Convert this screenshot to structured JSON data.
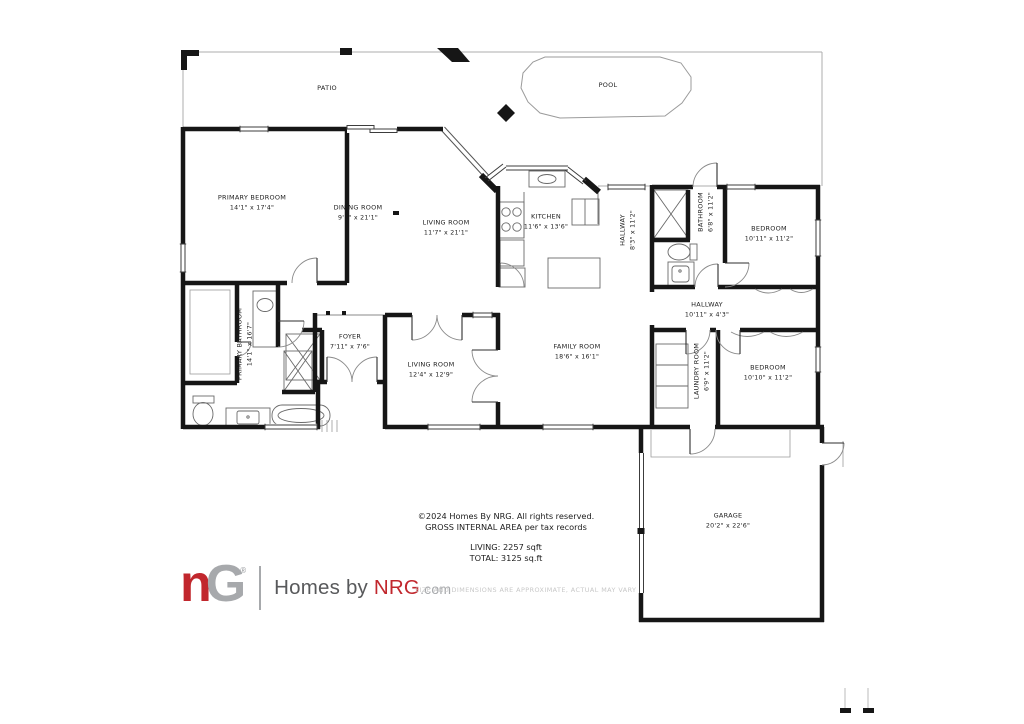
{
  "colors": {
    "wall": "#161616",
    "thin_line": "#aeaeae",
    "fixture_line": "#6a6a6a",
    "logo_red": "#c1272d",
    "logo_gray": "#a7a9ac",
    "brand_gray": "#58595b"
  },
  "plan": {
    "rooms": [
      {
        "name": "PATIO",
        "dims": "",
        "x": 327,
        "y": 89,
        "rot": false
      },
      {
        "name": "POOL",
        "dims": "",
        "x": 608,
        "y": 86,
        "rot": false
      },
      {
        "name": "PRIMARY BEDROOM",
        "dims": "14'1\" x 17'4\"",
        "x": 252,
        "y": 203,
        "rot": false
      },
      {
        "name": "DINING ROOM",
        "dims": "9'1\" x 21'1\"",
        "x": 358,
        "y": 213,
        "rot": false
      },
      {
        "name": "LIVING ROOM",
        "dims": "11'7\" x 21'1\"",
        "x": 446,
        "y": 228,
        "rot": false
      },
      {
        "name": "KITCHEN",
        "dims": "11'6\" x 13'6\"",
        "x": 546,
        "y": 222,
        "rot": false
      },
      {
        "name": "HALLWAY",
        "dims": "8'3\" x 11'2\"",
        "x": 628,
        "y": 230,
        "rot": true
      },
      {
        "name": "BATHROOM",
        "dims": "6'8\" x 11'2\"",
        "x": 706,
        "y": 212,
        "rot": true
      },
      {
        "name": "BEDROOM",
        "dims": "10'11\" x 11'2\"",
        "x": 769,
        "y": 234,
        "rot": false
      },
      {
        "name": "HALLWAY",
        "dims": "10'11\" x 4'3\"",
        "x": 707,
        "y": 310,
        "rot": false
      },
      {
        "name": "PRIMARY BATHROOM",
        "dims": "14'1\" x 16'7\"",
        "x": 245,
        "y": 344,
        "rot": true
      },
      {
        "name": "FOYER",
        "dims": "7'11\" x 7'6\"",
        "x": 350,
        "y": 342,
        "rot": false
      },
      {
        "name": "LIVING ROOM",
        "dims": "12'4\" x 12'9\"",
        "x": 431,
        "y": 370,
        "rot": false
      },
      {
        "name": "FAMILY ROOM",
        "dims": "18'6\" x 16'1\"",
        "x": 577,
        "y": 352,
        "rot": false
      },
      {
        "name": "LAUNDRY ROOM",
        "dims": "6'9\" x 11'2\"",
        "x": 702,
        "y": 371,
        "rot": true
      },
      {
        "name": "BEDROOM",
        "dims": "10'10\" x 11'2\"",
        "x": 768,
        "y": 373,
        "rot": false
      },
      {
        "name": "GARAGE",
        "dims": "20'2\" x 22'6\"",
        "x": 728,
        "y": 521,
        "rot": false
      }
    ]
  },
  "copyright": {
    "line1": "©2024 Homes By NRG. All rights reserved.",
    "line2": "GROSS INTERNAL AREA per tax records",
    "living": "LIVING: 2257 sqft",
    "total": "TOTAL: 3125 sq.ft"
  },
  "footer": {
    "logo_n": "n",
    "logo_g": "G",
    "reg": "®",
    "brand_prefix": "Homes by ",
    "brand_name": "NRG",
    "brand_tld": ".com",
    "disclaimer": "SIZE AND DIMENSIONS ARE APPROXIMATE, ACTUAL MAY VARY"
  }
}
